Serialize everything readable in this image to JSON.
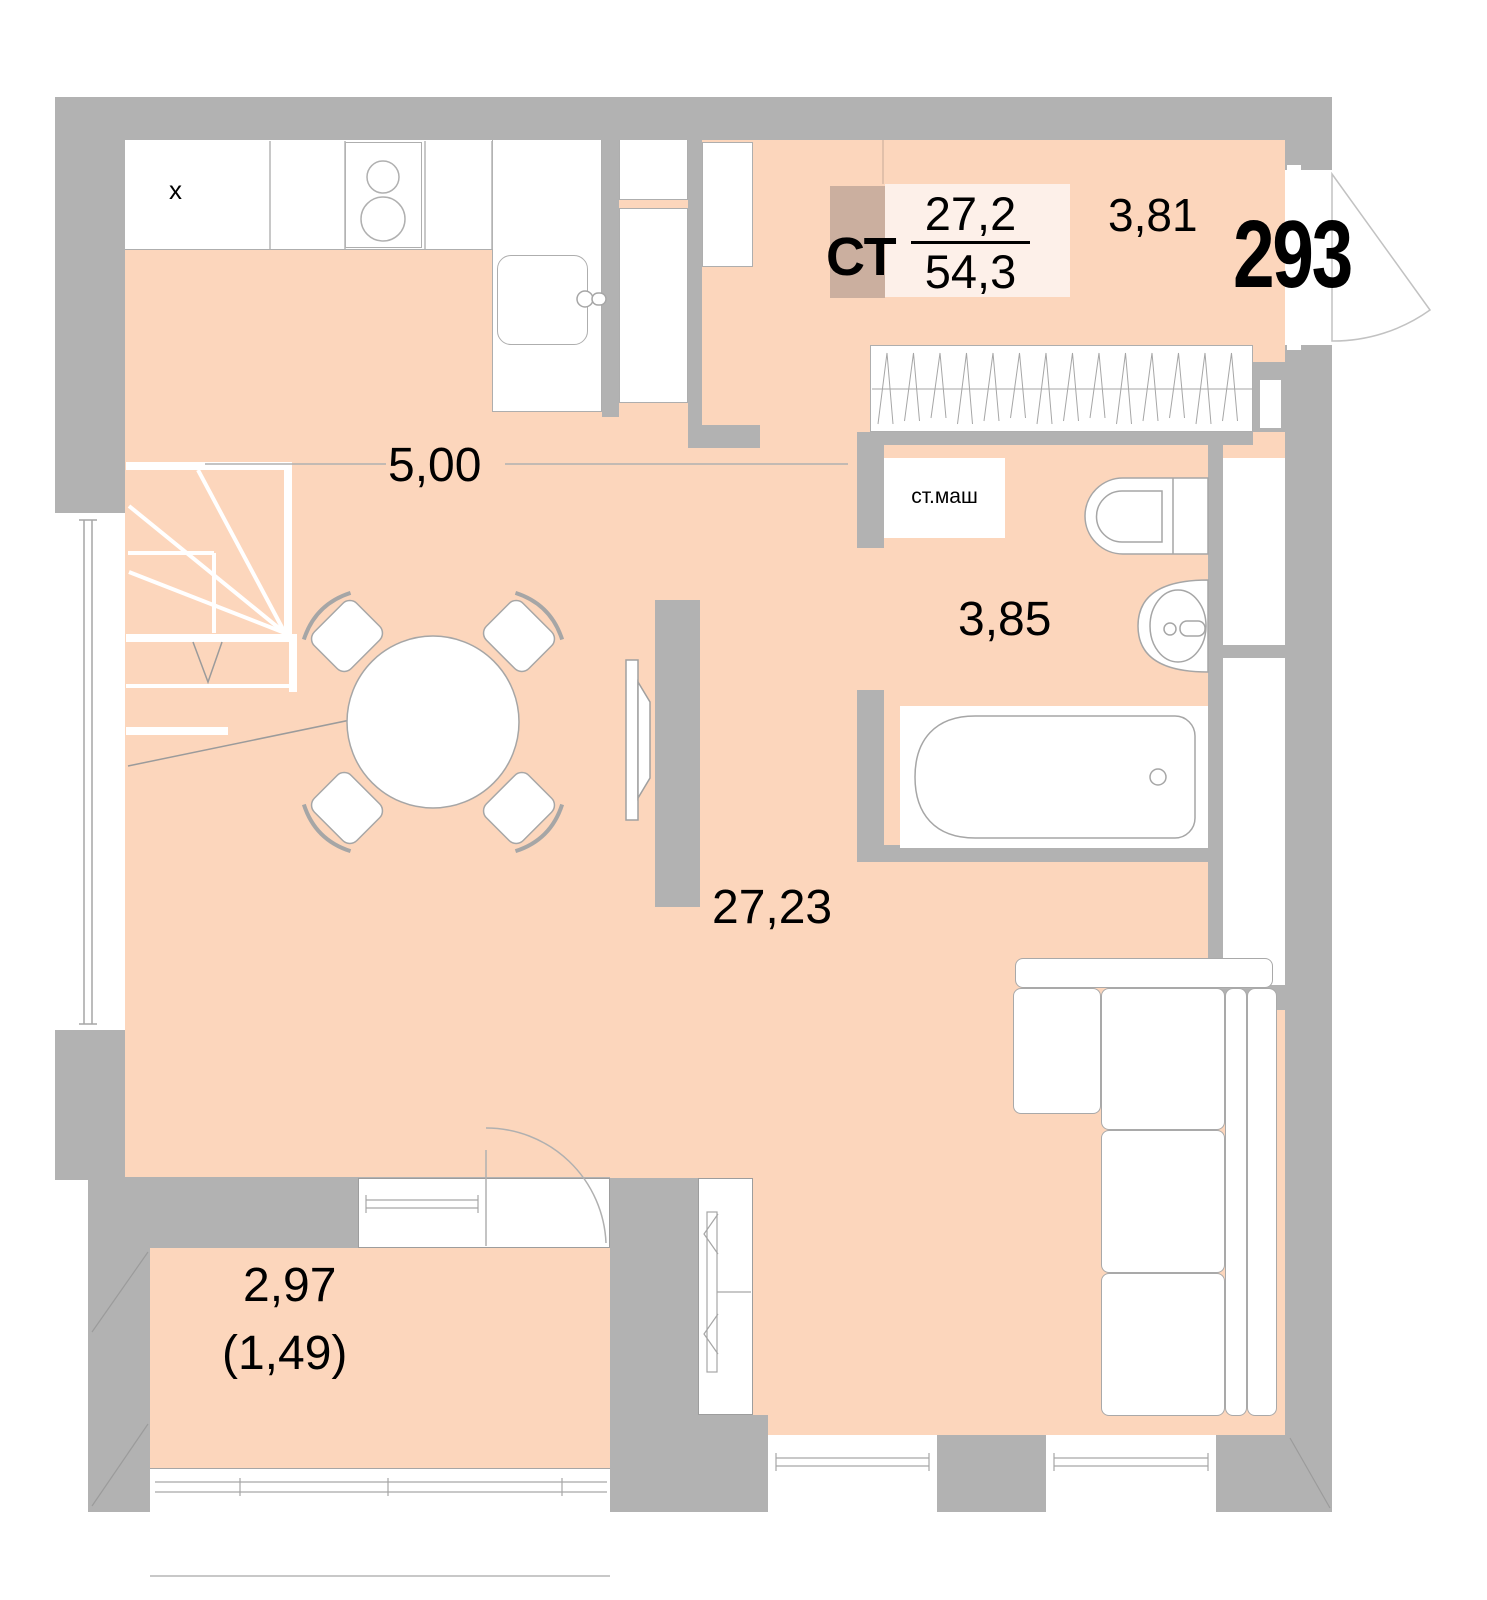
{
  "plan": {
    "title": "apartment-floor-plan",
    "flat": {
      "type_label": "СТ",
      "number": "293",
      "area_living": "27,2",
      "area_total": "54,3"
    },
    "rooms": {
      "kitchen_dim": "5,00",
      "hall_area": "3,81",
      "bath_area": "3,85",
      "living_area": "27,23",
      "balcony_area": "2,97",
      "balcony_area_coeff": "(1,49)"
    },
    "fixtures": {
      "washer_label": "ст.маш",
      "cabinet_mark": "x"
    },
    "colors": {
      "floor": "#fcd6bc",
      "wall": "#b2b2b2",
      "shade_box": "#cbaf9f",
      "area_box": "#fdf0e9",
      "outline": "#a6a6a6"
    }
  }
}
